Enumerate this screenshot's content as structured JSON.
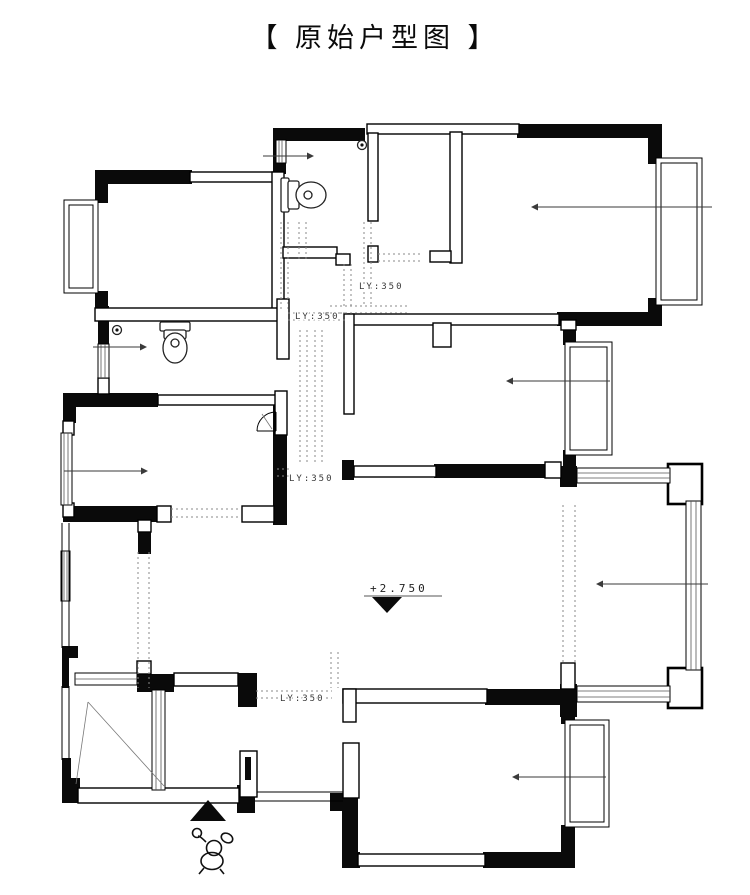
{
  "title": "【 原始户型图 】",
  "plan_labels": {
    "beam_label_1": "LY:350",
    "beam_label_2": "LY:350",
    "beam_label_3": "LY:350",
    "beam_label_4": "LY:350",
    "elevation_label": "+2.750"
  },
  "icons": {
    "toilet_top_bathroom": "toilet-icon",
    "toilet_left_bathroom": "toilet-icon",
    "floor_drain_top_bathroom": "floor-drain-icon",
    "floor_drain_left_bathroom": "floor-drain-icon",
    "entrance_marker": "entrance-triangle-icon",
    "elevation_marker": "elevation-marker-icon",
    "door_swing": "door-swing-icon",
    "mascot": "figure-mascot-icon",
    "direction_arrows": "direction-arrow-icon"
  },
  "colors": {
    "walls": "#0a0a0a",
    "background": "#ffffff",
    "dashed_lines": "#8a8a8a",
    "annotations": "#3a3a3a"
  }
}
